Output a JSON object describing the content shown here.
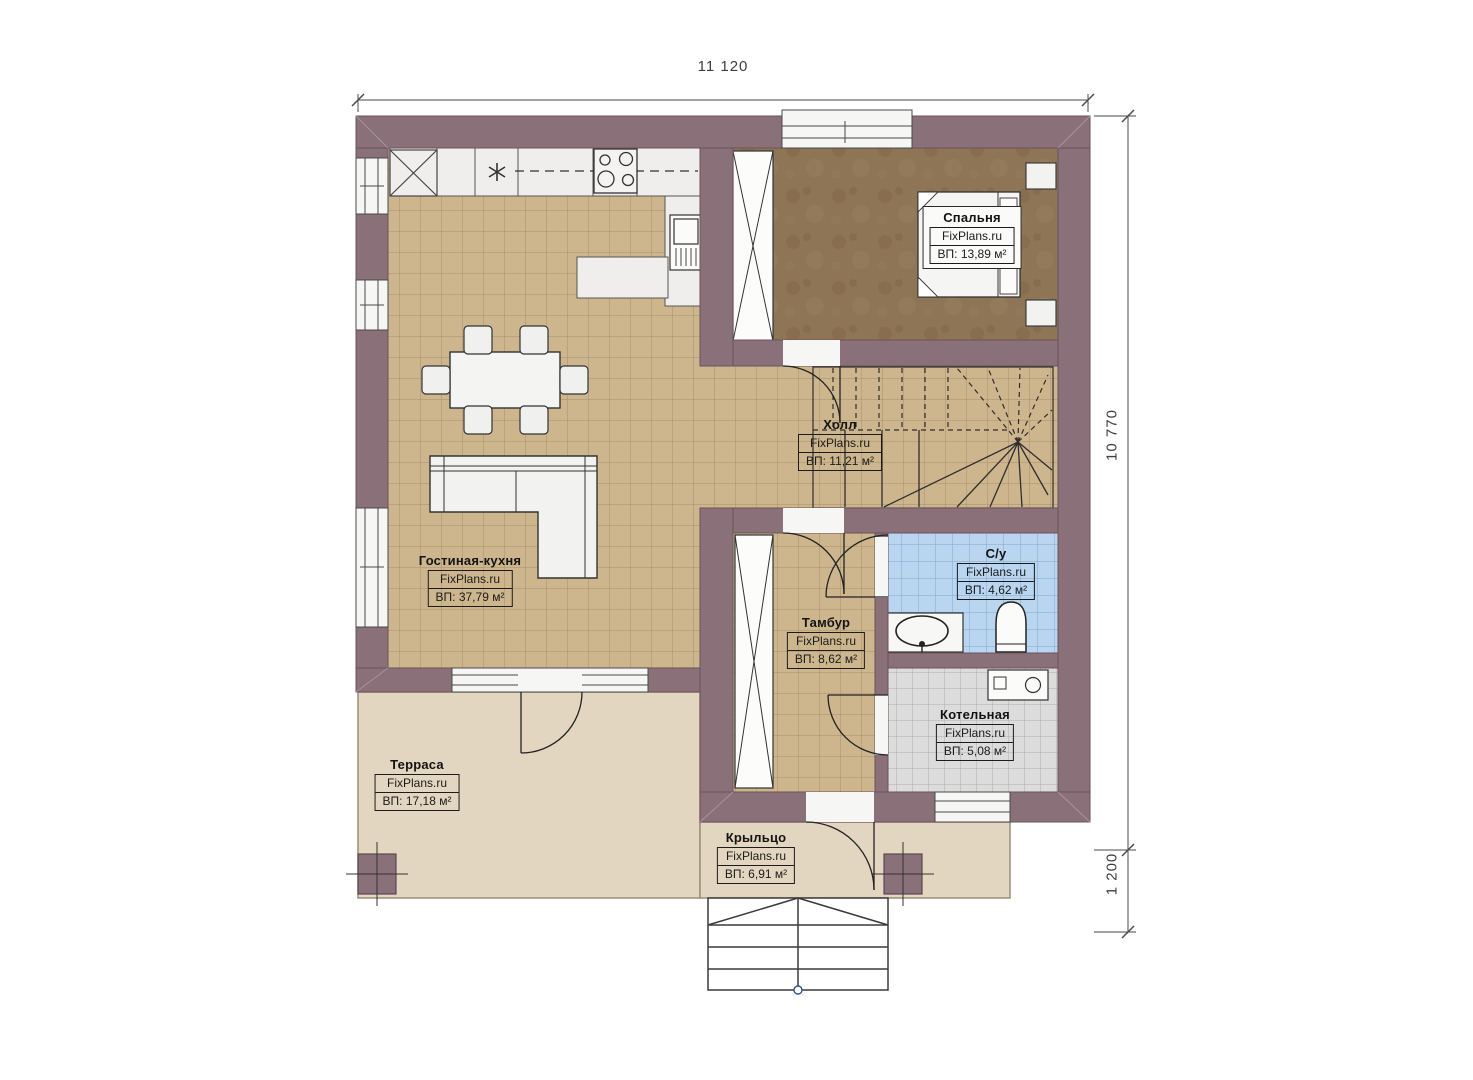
{
  "brand": "FixPlans.ru",
  "dimensions": {
    "top_width": "11 120",
    "right_height": "10 770",
    "right_porch": "1 200"
  },
  "rooms": [
    {
      "id": "bedroom",
      "name": "Спальня",
      "area": "ВП: 13,89 м²"
    },
    {
      "id": "hall",
      "name": "Холл",
      "area": "ВП: 11,21 м²"
    },
    {
      "id": "living-kitchen",
      "name": "Гостиная-кухня",
      "area": "ВП: 37,79 м²"
    },
    {
      "id": "bathroom",
      "name": "С/у",
      "area": "ВП: 4,62 м²"
    },
    {
      "id": "tambour",
      "name": "Тамбур",
      "area": "ВП: 8,62 м²"
    },
    {
      "id": "boiler",
      "name": "Котельная",
      "area": "ВП: 5,08 м²"
    },
    {
      "id": "terrace",
      "name": "Терраса",
      "area": "ВП: 17,18 м²"
    },
    {
      "id": "porch",
      "name": "Крыльцо",
      "area": "ВП: 6,91 м²"
    }
  ],
  "colors": {
    "wall": "#8a7078",
    "floor_tile": "#cdb68e",
    "bedroom_floor": "#8d7555",
    "bathroom_tile": "#b9d5ef",
    "boiler_tile": "#dcdcdc",
    "terrace_slab": "#e3d6c0"
  }
}
